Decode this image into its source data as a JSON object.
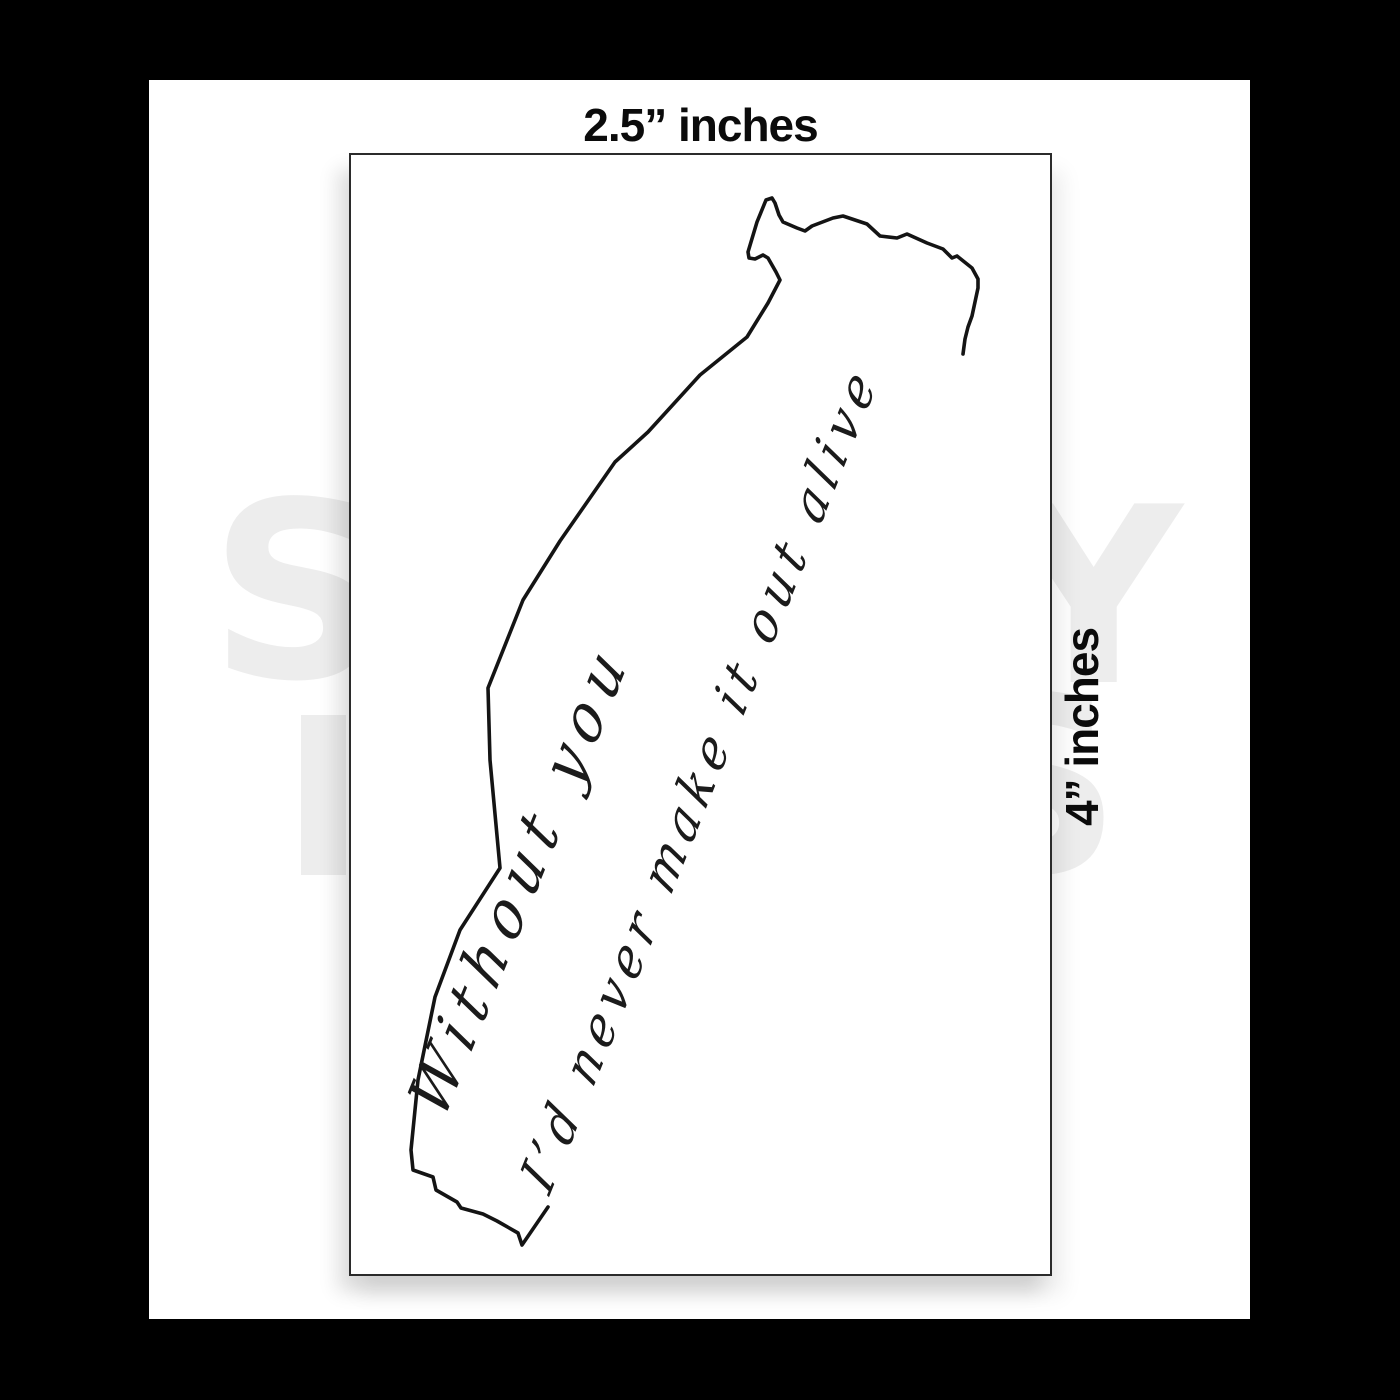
{
  "mockup": {
    "top_size_label": "2.5” inches",
    "side_size_label": "4” inches"
  },
  "sticker": {
    "script_line1": "Without you",
    "script_line2": "I’d never make it out alive"
  },
  "watermark": {
    "row1_left_letter": "S",
    "row1_right_letter": "Y",
    "row2_right_letter": "S"
  },
  "colors": {
    "page_background": "#000000",
    "canvas": "#ffffff",
    "card_border": "#2b2b2b",
    "ink": "#141414",
    "label_text": "#0b0b0b",
    "watermark": "#ededed"
  }
}
